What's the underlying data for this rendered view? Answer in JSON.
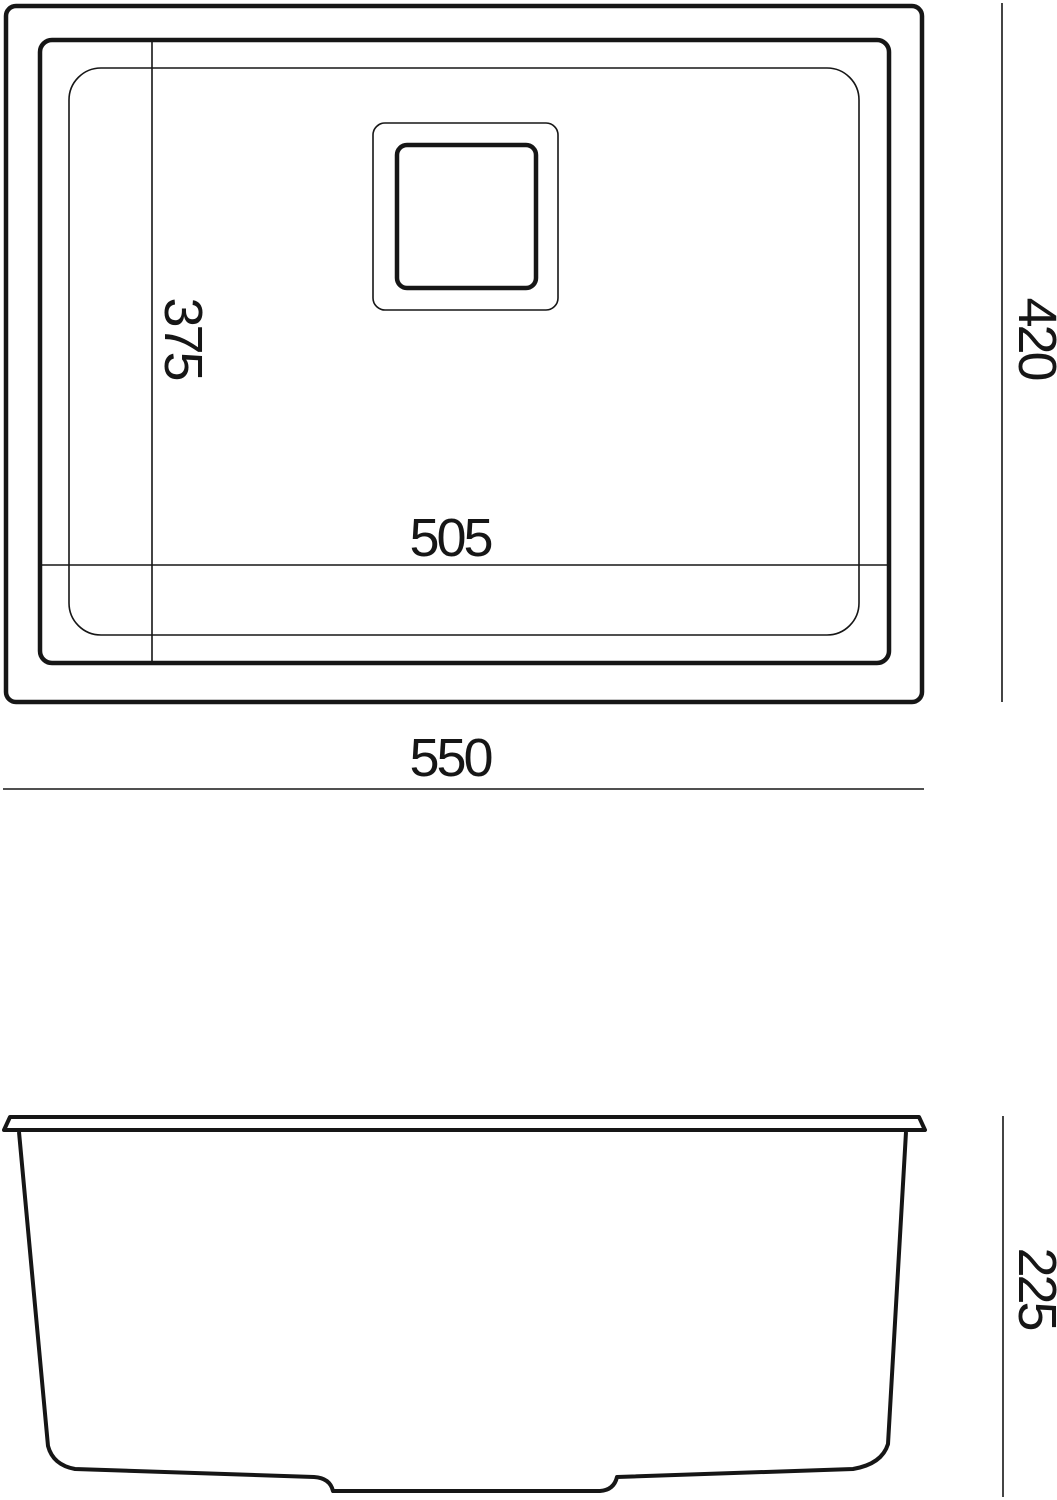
{
  "colors": {
    "ink": "#161616",
    "paper": "#ffffff"
  },
  "drawing": {
    "type": "technical-dimension-drawing",
    "subject": "undermount kitchen sink, top view and side section view"
  },
  "top_view": {
    "inner_width_label": "505",
    "inner_depth_label": "375",
    "overall_width_label": "550",
    "overall_depth_label": "420"
  },
  "side_view": {
    "height_label": "225"
  }
}
